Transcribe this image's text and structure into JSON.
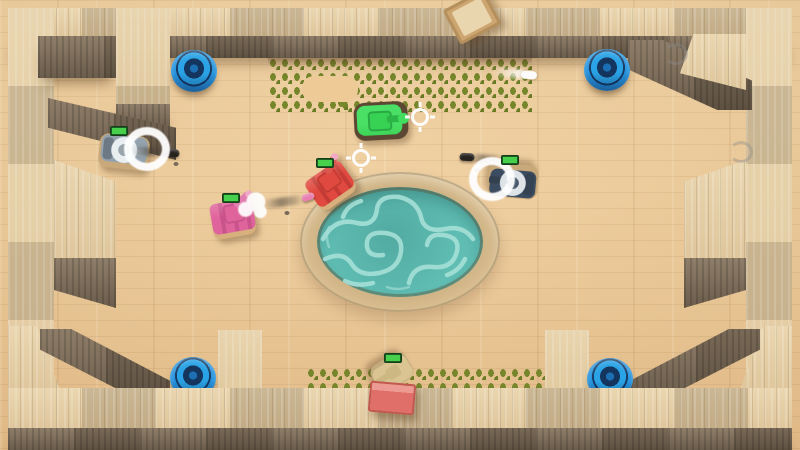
{
  "palette": {
    "floor": "#eecb98",
    "wall_top": "#e6d1aa",
    "wall_front": "#7d6d5a",
    "water": "#5fbdb3",
    "water_caustic": "#a6e0d8",
    "pool_rim": "#cdb183",
    "grass": "#73842a",
    "health_green": "#46d04c",
    "puck_blue": "#2593dd",
    "crosshair": "#ffffff"
  },
  "arena": {
    "pool": {
      "cx": 400,
      "cy": 242,
      "rx": 100,
      "ry": 70
    }
  },
  "entities": {
    "tanks": {
      "green": {
        "x": 381,
        "y": 121,
        "rot": -3,
        "colors": {
          "body": "#3ed658",
          "turret": "#37d254",
          "barrel": "#2db648",
          "base": "#5c4733"
        }
      },
      "white": {
        "x": 124,
        "y": 152,
        "rot": 6,
        "colors": {
          "body": "#93a2ac",
          "ring": "#e9eef1",
          "hub": "#97a4ab",
          "barrel": "#9fadb5",
          "base": "#c9a979"
        }
      },
      "pink": {
        "x": 233,
        "y": 219,
        "rot": -10,
        "colors": {
          "body": "#e0649c",
          "stripe": "#c9538b",
          "barrel": "#e27daf",
          "tip": "#f0a8c8",
          "base": "#d8b07e"
        }
      },
      "red": {
        "x": 331,
        "y": 186,
        "rot": -35,
        "colors": {
          "body": "#e0493f",
          "stripe": "#c43c35",
          "barrel": "#da5850",
          "tip": "#f2a9c6",
          "base": "#d8b07e"
        }
      },
      "navy": {
        "x": 513,
        "y": 181,
        "rot": 185,
        "colors": {
          "body": "#3c4c60",
          "ring": "#dde3e7",
          "hub": "#49596c",
          "barrel": "#33414f",
          "base": "#c9a979"
        }
      },
      "tan": {
        "x": 392,
        "y": 372,
        "rot": 148,
        "colors": {
          "body": "#d9c492",
          "turret": "#cdb883",
          "base": "#c2ab7c"
        }
      }
    },
    "pucks": {
      "top_left": {
        "x": 194,
        "y": 71
      },
      "top_right": {
        "x": 607,
        "y": 70
      },
      "bottom_left": {
        "x": 193,
        "y": 378
      },
      "bottom_right": {
        "x": 610,
        "y": 379
      }
    },
    "crosshairs": {
      "a": {
        "x": 420,
        "y": 117
      },
      "b": {
        "x": 361,
        "y": 158
      }
    },
    "health_bars": {
      "white": {
        "x": 119,
        "y": 131
      },
      "pink": {
        "x": 231,
        "y": 198
      },
      "red": {
        "x": 325,
        "y": 163
      },
      "navy": {
        "x": 510,
        "y": 160
      },
      "tan": {
        "x": 393,
        "y": 358
      }
    },
    "bullets": {
      "black_left": {
        "x": 172,
        "y": 153,
        "rot": 4
      },
      "black_right": {
        "x": 467,
        "y": 157,
        "rot": 3
      },
      "pink_shell": {
        "x": 308,
        "y": 197,
        "rot": -18
      },
      "white_shell": {
        "x": 529,
        "y": 75,
        "rot": 4
      }
    },
    "trails": {
      "left": {
        "x": 150,
        "y": 152,
        "rot": 4,
        "w": 34
      },
      "right": {
        "x": 484,
        "y": 159,
        "rot": 3,
        "w": 30
      },
      "pink": {
        "x": 283,
        "y": 202,
        "rot": -8,
        "w": 42
      },
      "white": {
        "x": 508,
        "y": 73,
        "rot": 4,
        "w": 34
      }
    },
    "smoke_puffs": {
      "white_tank": {
        "x": 147,
        "y": 149
      },
      "pink_tank": {
        "x": 252,
        "y": 206
      },
      "navy_tank": {
        "x": 492,
        "y": 179
      }
    },
    "smoke_wisps": {
      "a": {
        "x": 676,
        "y": 54
      },
      "b": {
        "x": 741,
        "y": 152
      }
    },
    "debris": {
      "a": {
        "x": 176,
        "y": 164
      },
      "b": {
        "x": 287,
        "y": 213
      },
      "c": {
        "x": 477,
        "y": 170
      }
    },
    "boxes": {
      "cardboard": {
        "x": 472,
        "y": 17,
        "rot": -28
      },
      "red": {
        "x": 392,
        "y": 398,
        "rot": 5
      }
    }
  }
}
